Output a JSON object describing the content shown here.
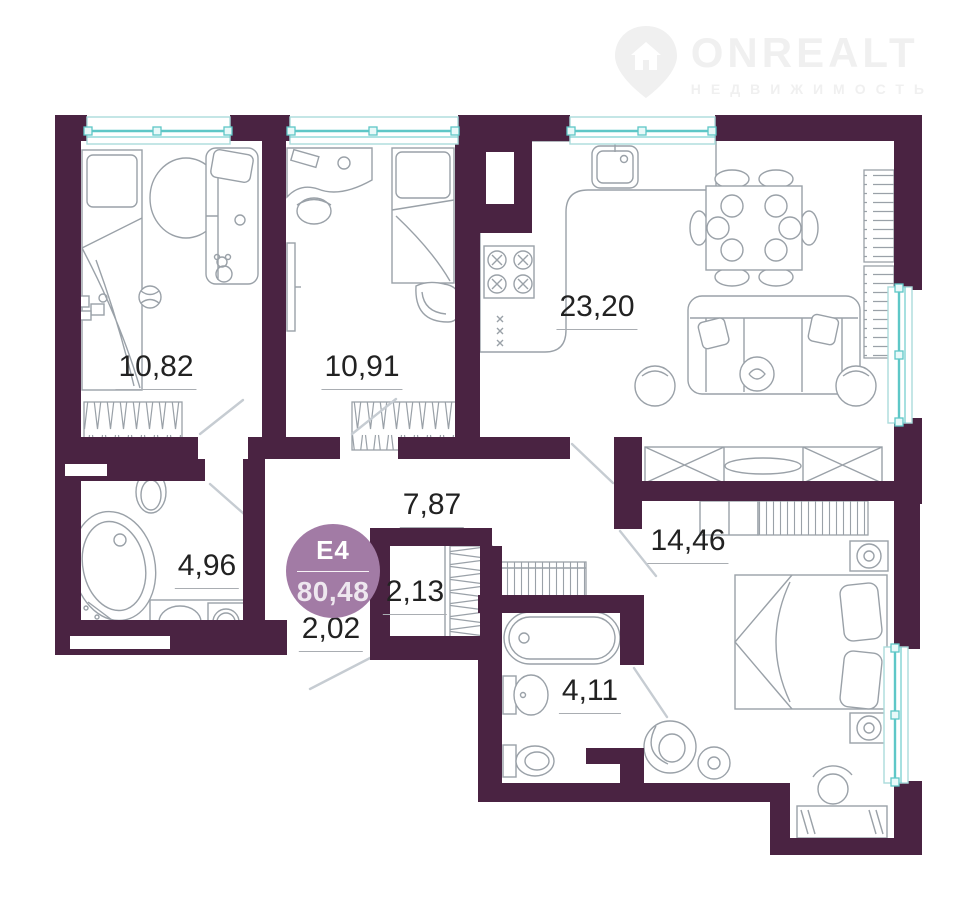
{
  "watermark": {
    "brand": "ONREALT",
    "tagline": "НЕДВИЖИМОСТЬ"
  },
  "unit_badge": {
    "unit": "Е4",
    "total_area": "80,48"
  },
  "rooms": [
    {
      "name": "bedroom-1",
      "area": "10,82"
    },
    {
      "name": "bedroom-2",
      "area": "10,91"
    },
    {
      "name": "kitchen-living-room",
      "area": "23,20"
    },
    {
      "name": "hallway",
      "area": "7,87"
    },
    {
      "name": "wardrobe-closet",
      "area": "2,13"
    },
    {
      "name": "entry-corridor",
      "area": "2,02"
    },
    {
      "name": "bathroom",
      "area": "4,96"
    },
    {
      "name": "wc-bathroom",
      "area": "4,11"
    },
    {
      "name": "bedroom-3",
      "area": "14,46"
    }
  ],
  "colors": {
    "wall": "#4a2342",
    "window": "#5ec7c7",
    "window-sill": "#aadcdc",
    "furniture": "#9aa1a8",
    "badge": "#a27ba5",
    "label": "#222222",
    "watermark": "#f0f0f0"
  }
}
